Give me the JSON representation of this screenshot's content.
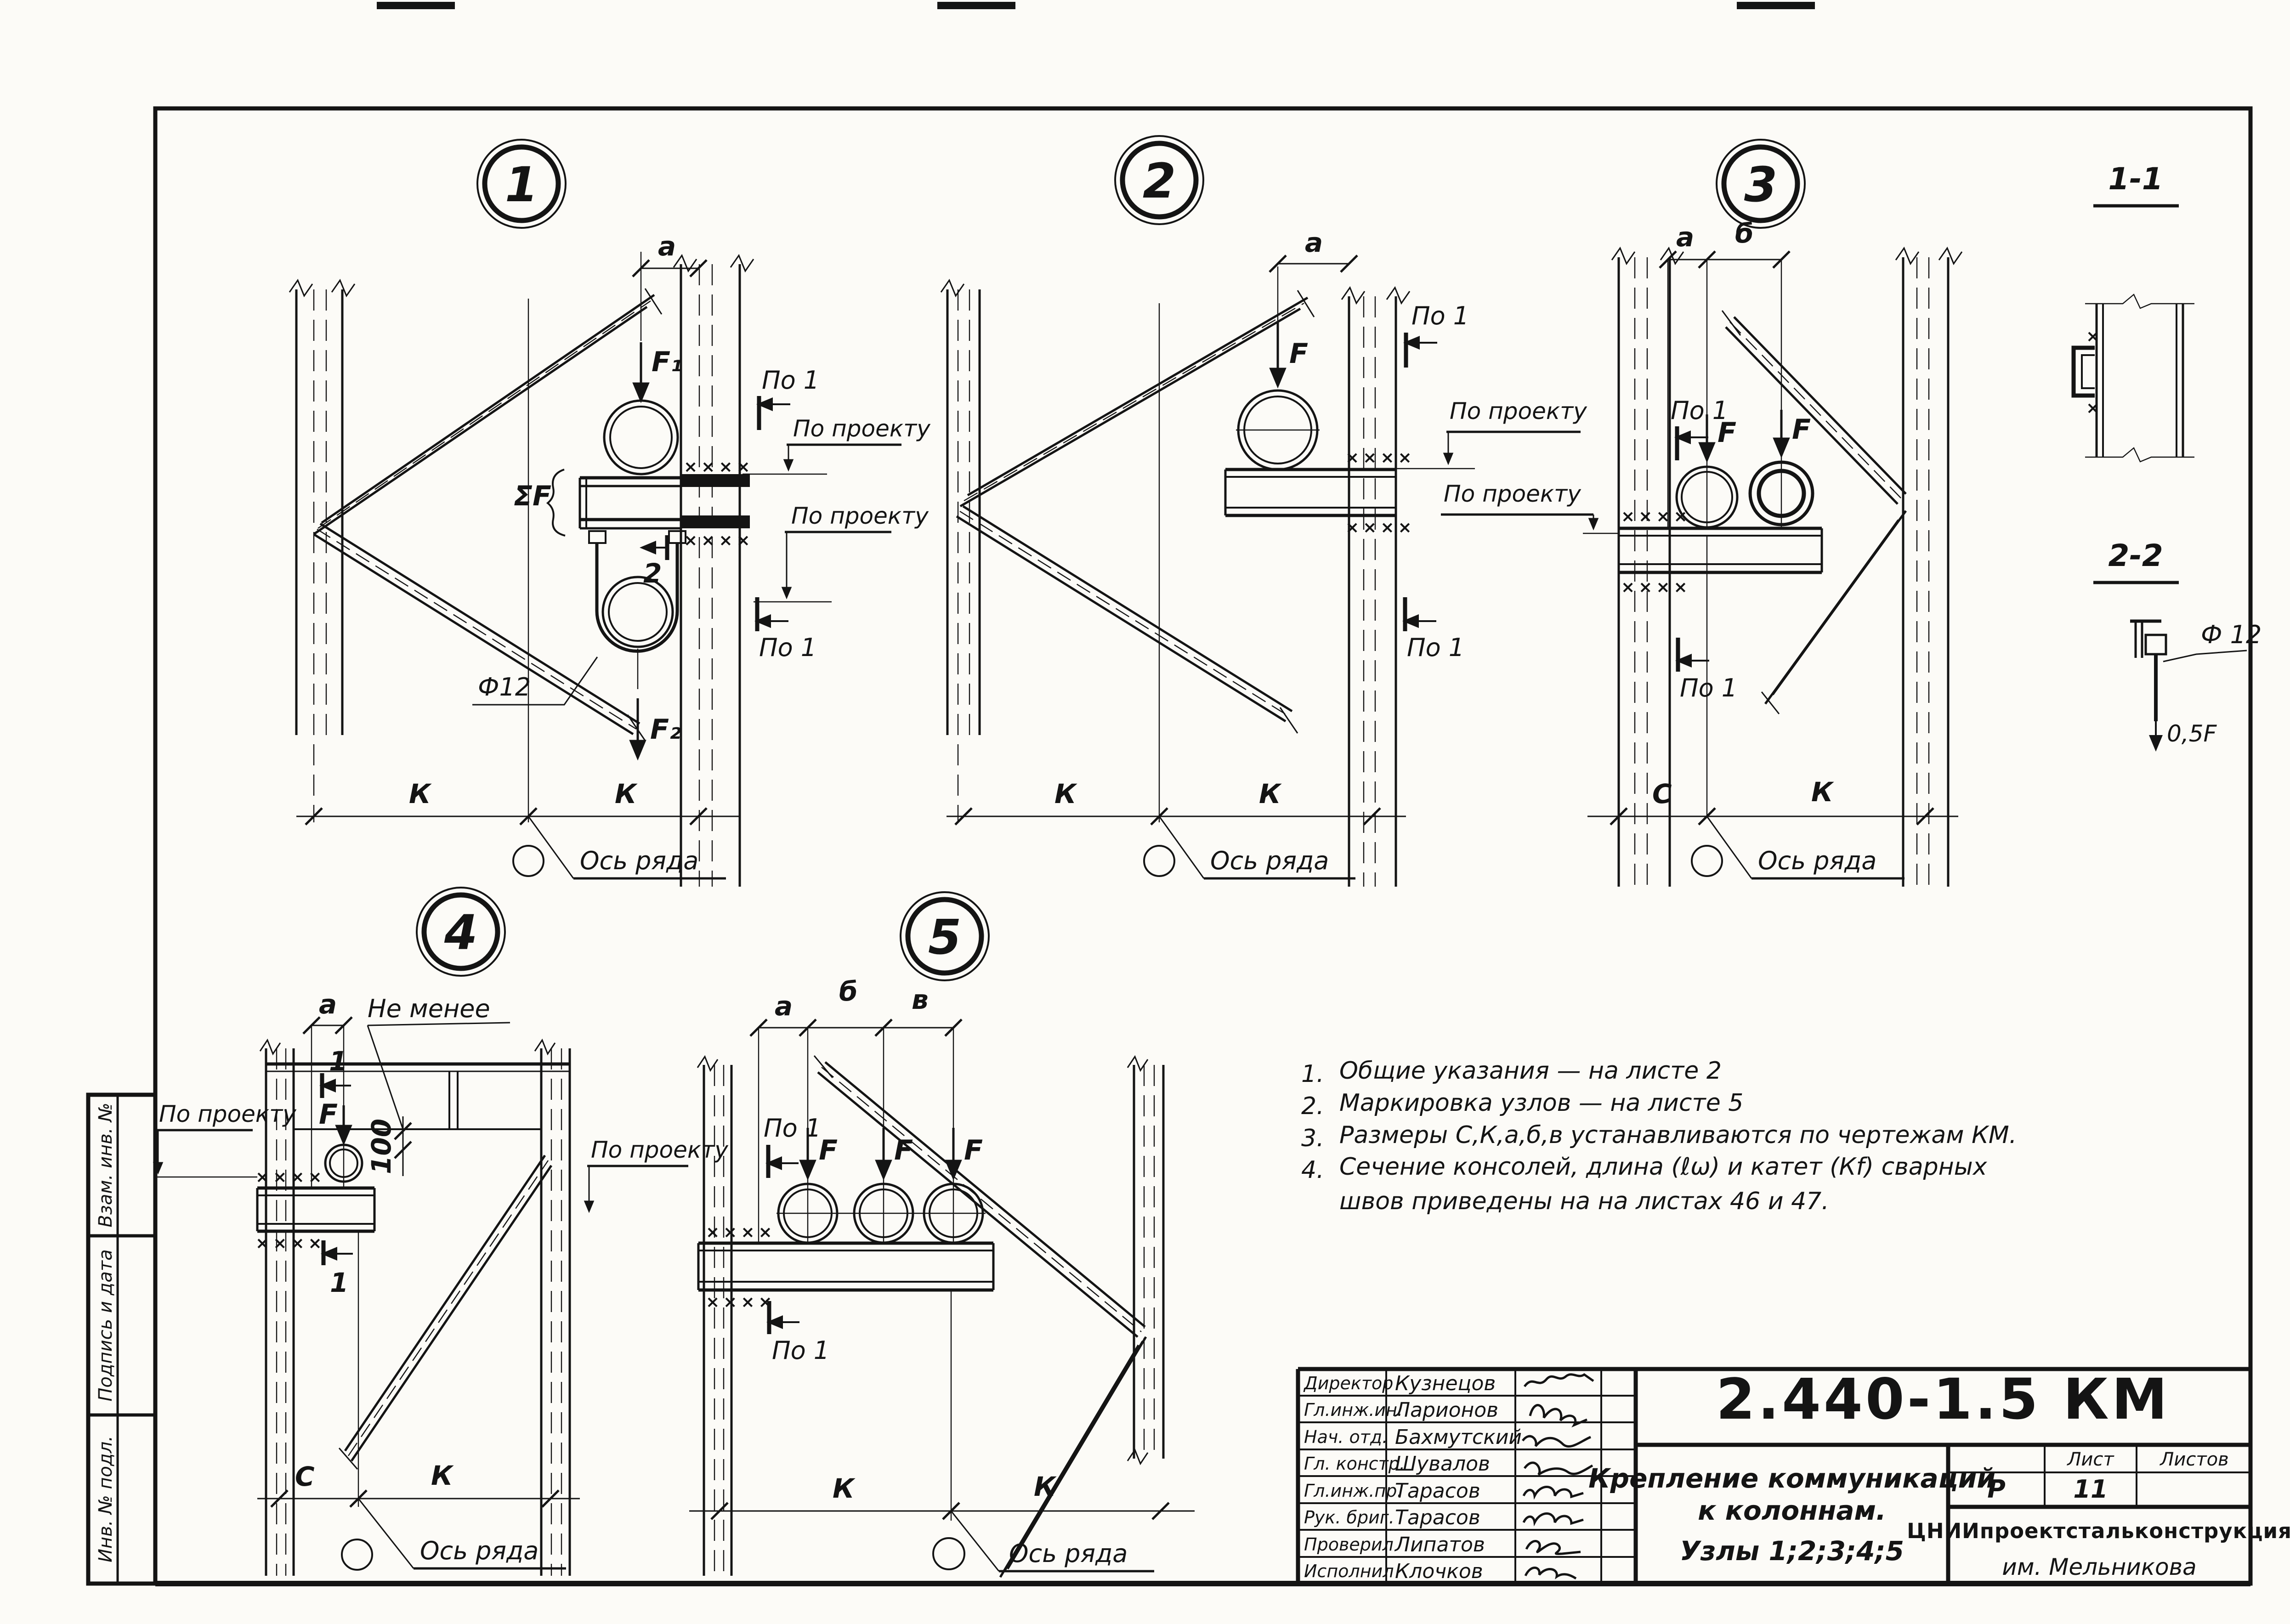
{
  "sheet": {
    "code": "2.440-1.5 КМ",
    "title_line1": "Крепление коммуникаций",
    "title_line2": "к колоннам.",
    "title_line3": "Узлы 1;2;3;4;5",
    "stage": "Р",
    "sheet_label": "Лист",
    "sheets_label": "Листов",
    "sheet_number": "11",
    "org_name": "ЦНИИпроектстальконструкция",
    "org_name2": "им. Мельникова"
  },
  "signatures": {
    "rows": [
      {
        "role": "Директор",
        "name": "Кузнецов"
      },
      {
        "role": "Гл.инж.ин.",
        "name": "Ларионов"
      },
      {
        "role": "Нач. отд.",
        "name": "Бахмутский"
      },
      {
        "role": "Гл. констр.",
        "name": "Шувалов"
      },
      {
        "role": "Гл.инж.пр.",
        "name": "Тарасов"
      },
      {
        "role": "Рук. бриг.",
        "name": "Тарасов"
      },
      {
        "role": "Проверил",
        "name": "Липатов"
      },
      {
        "role": "Исполнил",
        "name": "Клочков"
      }
    ]
  },
  "sidebar": {
    "items": [
      "Взам. инв. №",
      "Подпись и дата",
      "Инв. № подл."
    ]
  },
  "notes": {
    "items": [
      {
        "num": "1.",
        "text": "Общие  указания — на листе 2"
      },
      {
        "num": "2.",
        "text": "Маркировка  узлов — на листе 5"
      },
      {
        "num": "3.",
        "text": "Размеры  С,К,а,б,в  устанавливаются  по чертежам КМ."
      },
      {
        "num": "4.",
        "text": "Сечение  консолей,  длина (ℓω)  и катет (Кf) сварных"
      }
    ],
    "item4_line2": "швов  приведены  на  на листах  46 и 47."
  },
  "nodes": {
    "n1": "1",
    "n2": "2",
    "n3": "3",
    "n4": "4",
    "n5": "5"
  },
  "sections": {
    "s11": "1-1",
    "s22": "2-2"
  },
  "labels": {
    "po1": "По 1",
    "po_proektu": "По проекту",
    "os_ryada": "Ось ряда",
    "ne_menee": "Не менее",
    "dim_a": "a",
    "dim_b": "б",
    "dim_v": "в",
    "dim_c": "С",
    "dim_k": "К",
    "f": "F",
    "f1": "F₁",
    "f2": "F₂",
    "sum_f": "ΣF",
    "phi12": "Ф12",
    "phi12s": "Ф 12",
    "d100": "100",
    "half_f": "0,5F",
    "sec1": "1",
    "sec2": "2",
    "weld4": "××××",
    "weld1": "×"
  }
}
